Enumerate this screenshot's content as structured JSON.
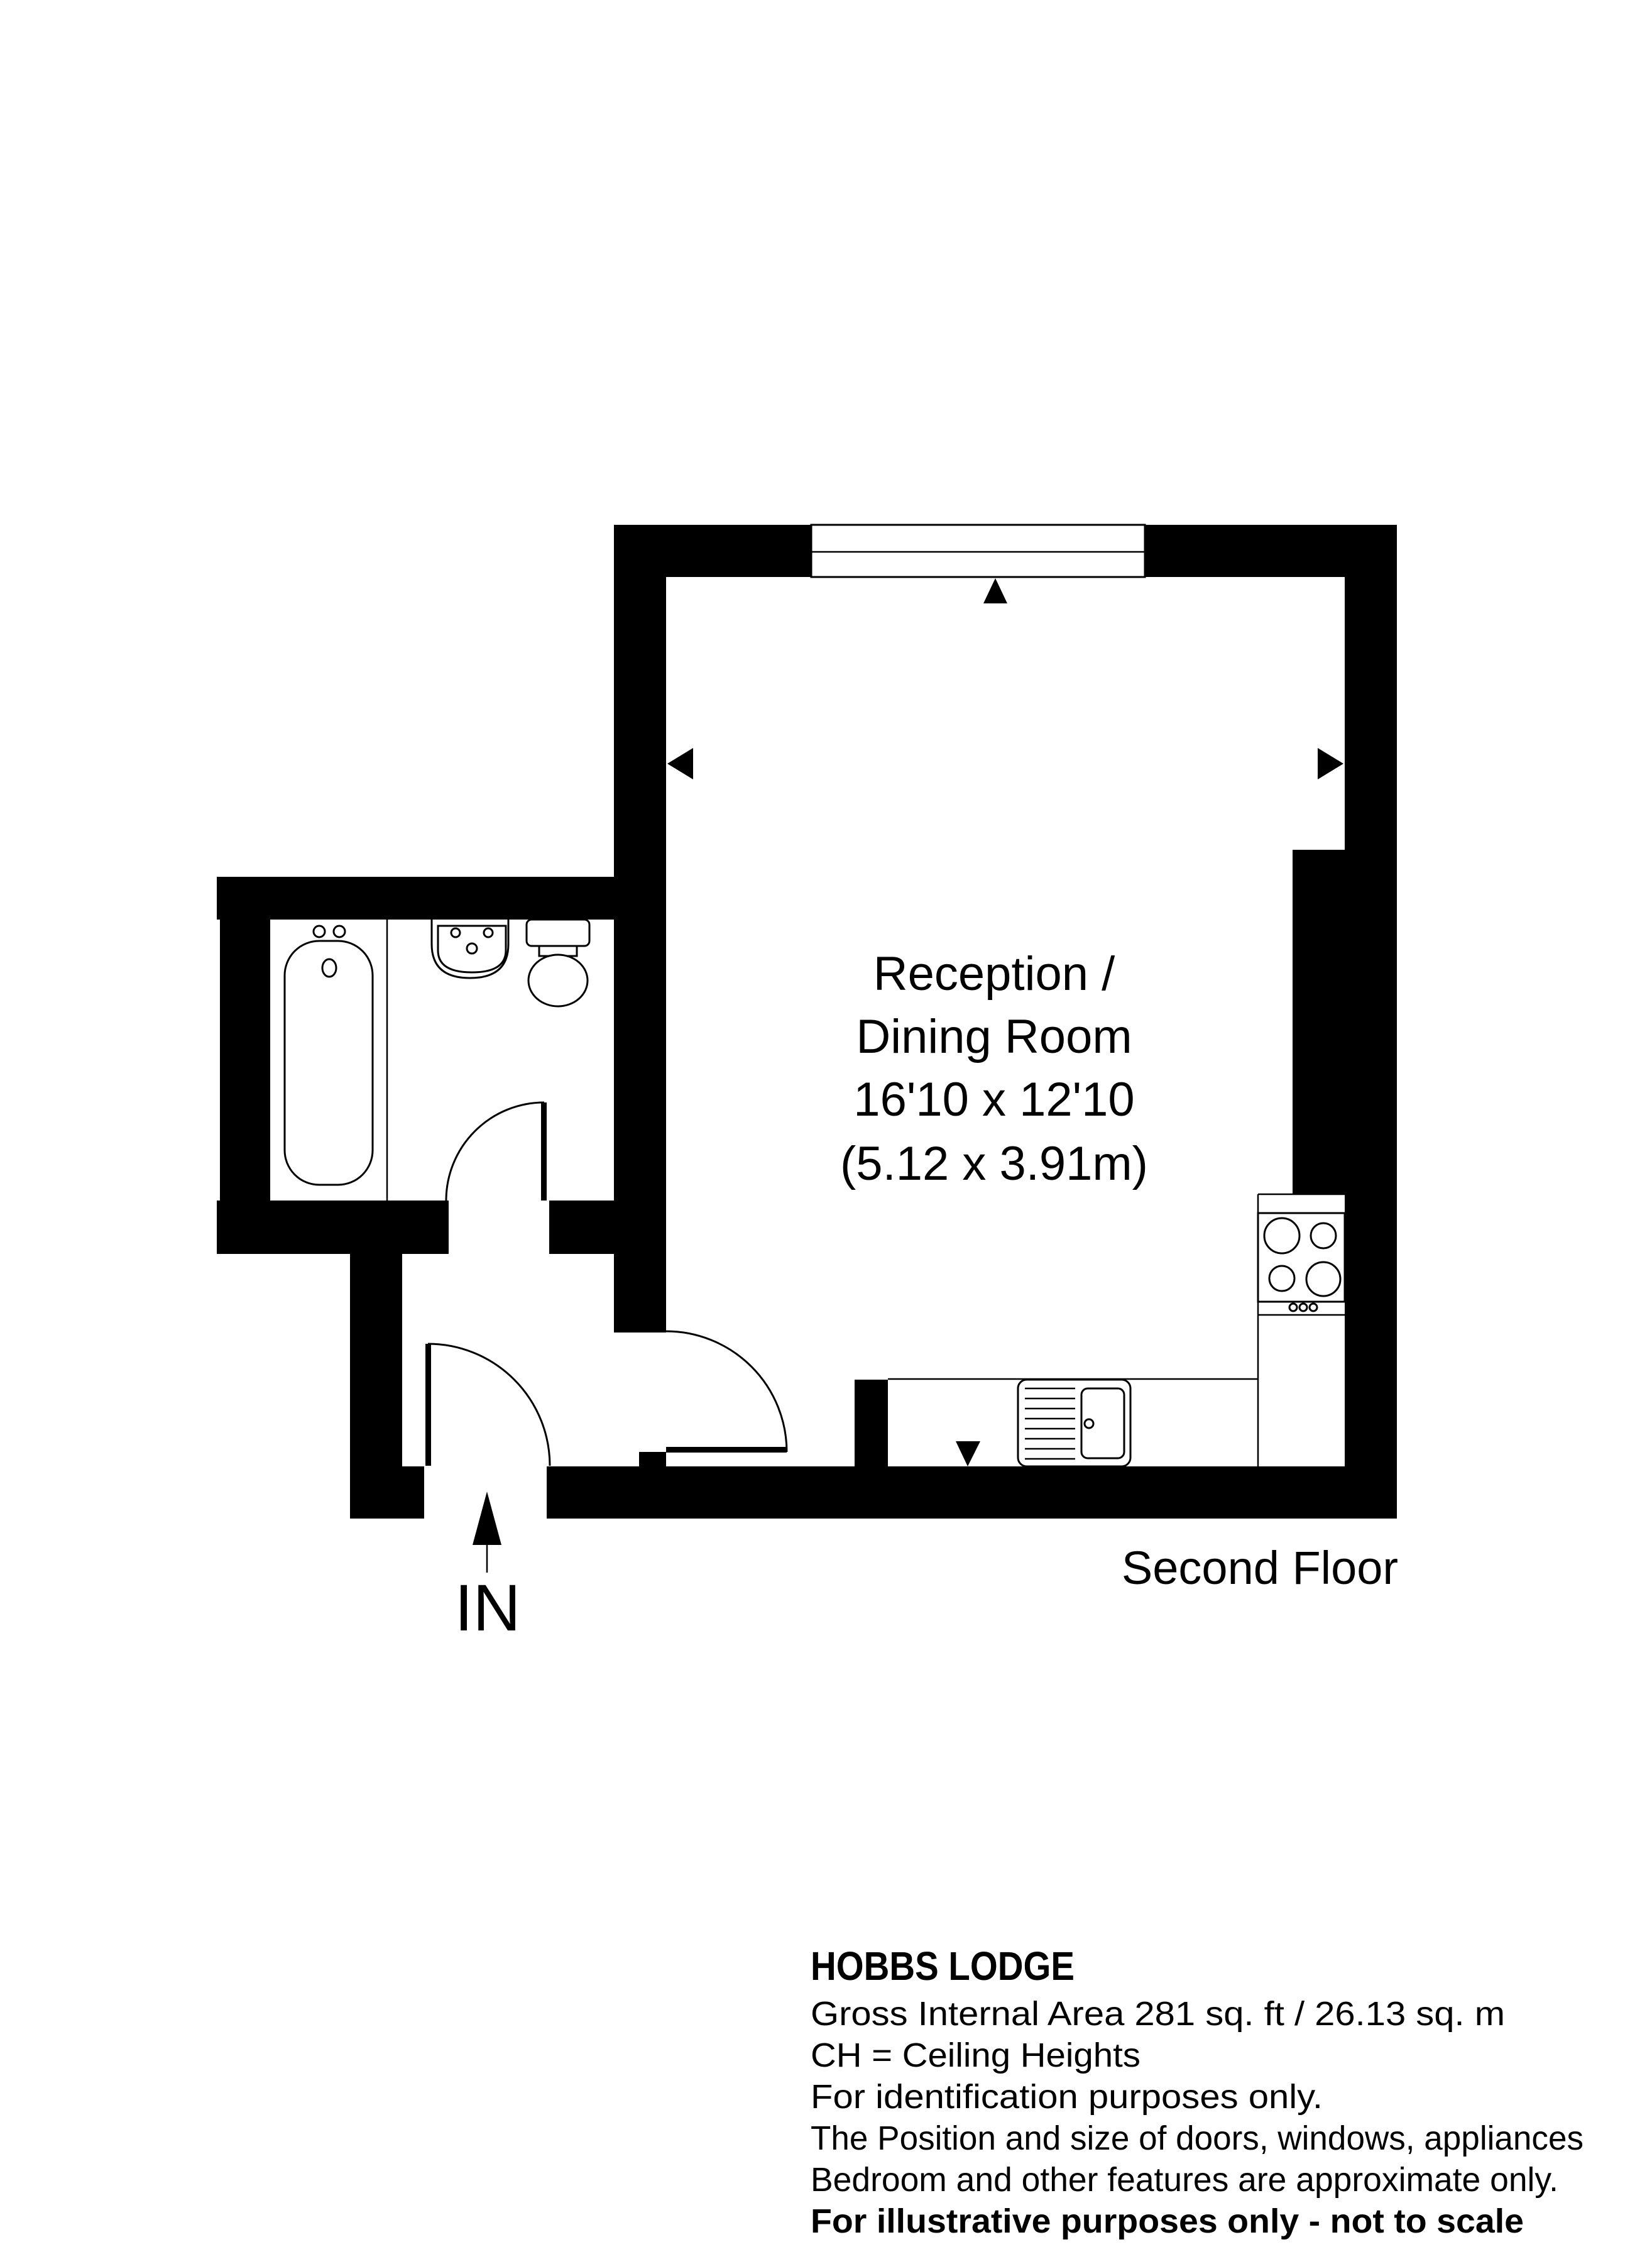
{
  "meta": {
    "background_color": "#ffffff",
    "ink_color": "#000000",
    "drawing_type": "floor-plan"
  },
  "plan": {
    "room_label": {
      "line1": "Reception /",
      "line2": "Dining Room",
      "line3": "16'10 x 12'10",
      "line4": "(5.12 x 3.91m)"
    },
    "floor_label": "Second Floor",
    "entrance_label": "IN"
  },
  "footer": {
    "title": "HOBBS LODGE",
    "line1": "Gross Internal Area 281 sq. ft / 26.13 sq. m",
    "line2": "CH = Ceiling Heights",
    "line3": "For identification purposes only.",
    "line4": "The Position and size of doors, windows, appliances",
    "line5": "Bedroom and other features are approximate only.",
    "line6": "For illustrative purposes only - not to scale"
  }
}
